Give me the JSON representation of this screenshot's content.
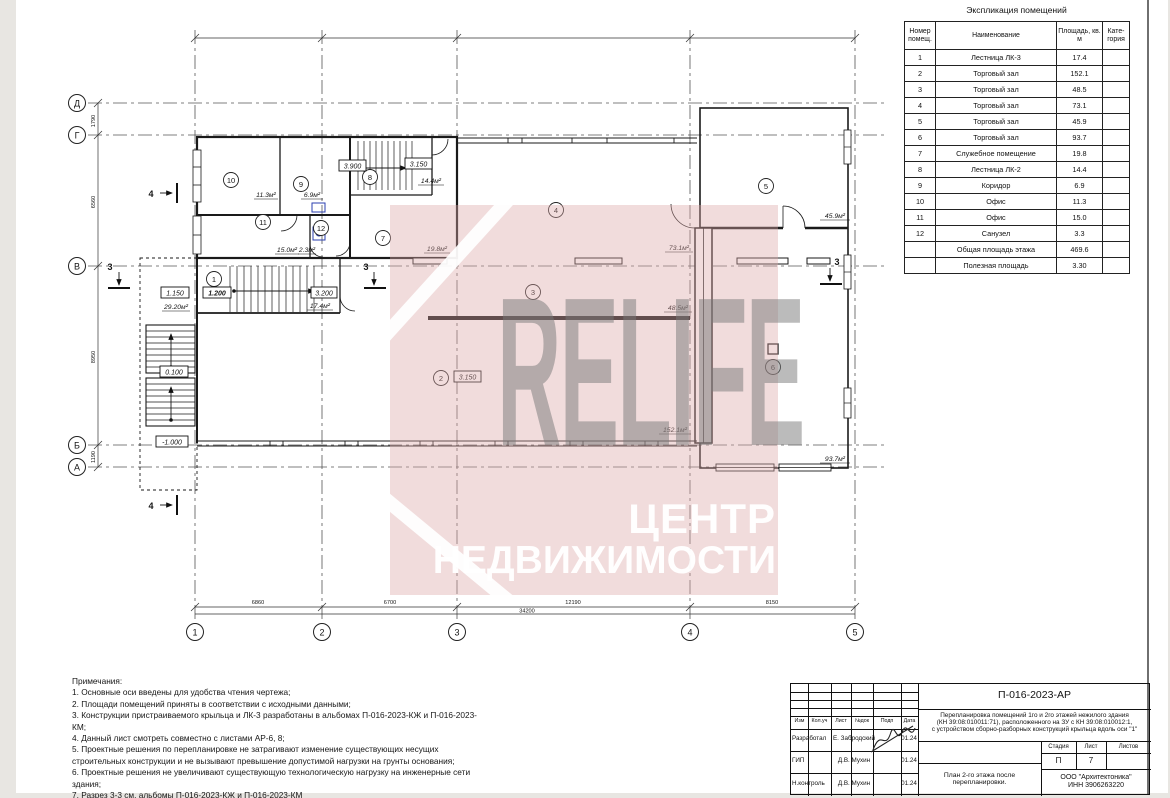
{
  "watermark": {
    "brand": "RELIFE",
    "line1": "ЦЕНТР",
    "line2": "НЕДВИЖИМОСТИ"
  },
  "explication": {
    "title": "Экспликация помещений",
    "headers": [
      "Номер помещ.",
      "Наименование",
      "Площадь, кв. м",
      "Кате-гория"
    ],
    "rows": [
      {
        "num": "1",
        "name": "Лестница ЛК-3",
        "area": "17.4"
      },
      {
        "num": "2",
        "name": "Торговый зал",
        "area": "152.1"
      },
      {
        "num": "3",
        "name": "Торговый зал",
        "area": "48.5"
      },
      {
        "num": "4",
        "name": "Торговый зал",
        "area": "73.1"
      },
      {
        "num": "5",
        "name": "Торговый зал",
        "area": "45.9"
      },
      {
        "num": "6",
        "name": "Торговый зал",
        "area": "93.7"
      },
      {
        "num": "7",
        "name": "Служебное помещение",
        "area": "19.8"
      },
      {
        "num": "8",
        "name": "Лестница ЛК-2",
        "area": "14.4"
      },
      {
        "num": "9",
        "name": "Коридор",
        "area": "6.9"
      },
      {
        "num": "10",
        "name": "Офис",
        "area": "11.3"
      },
      {
        "num": "11",
        "name": "Офис",
        "area": "15.0"
      },
      {
        "num": "12",
        "name": "Санузел",
        "area": "3.3"
      }
    ],
    "totals": [
      {
        "name": "Общая площадь этажа",
        "area": "469.6"
      },
      {
        "name": "Полезная площадь",
        "area": "3.30"
      }
    ]
  },
  "notes": {
    "title": "Примечания:",
    "items": [
      "1. Основные оси введены для удобства чтения чертежа;",
      "2. Площади помещений приняты в соответствии с исходными данными;",
      "3. Конструкции пристраиваемого крыльца и ЛК-3 разработаны в альбомах П-016-2023-КЖ и П-016-2023-КМ;",
      "4. Данный лист смотреть совместно с листами АР-6, 8;",
      "5. Проектные решения по перепланировке не затрагивают изменение существующих несущих строительных конструкции и не вызывают превышение допустимой нагрузки на грунты основания;",
      "6. Проектные решения не увеличивают существующую технологическую нагрузку на инженерные сети здания;",
      "7. Разрез 3-3 см. альбомы П-016-2023-КЖ и П-016-2023-КМ"
    ]
  },
  "title_block": {
    "code": "П-016-2023-АР",
    "desc_line1": "Перепланировка помещений 1го и 2го этажей нежилого здания",
    "desc_line2": "(КН 39:08:010011:71), расположенного на ЗУ с КН 39:08:010012:1,",
    "desc_line3": "с устройством сборно-разборных конструкций крыльца вдоль оси \"1\"",
    "columns": [
      "Изм",
      "Кол.уч",
      "Лист",
      "№док",
      "Подп",
      "Дата"
    ],
    "staff": [
      {
        "role": "Разработал",
        "name": "Е. Забродский",
        "date": "01.24"
      },
      {
        "role": "ГИП",
        "name": "Д.В. Мухин",
        "date": "01.24"
      },
      {
        "role": "Н.контроль",
        "name": "Д.В. Мухин",
        "date": "01.24"
      }
    ],
    "stage_headers": [
      "Стадия",
      "Лист",
      "Листов"
    ],
    "stage": "П",
    "sheet": "7",
    "sheets": "",
    "caption": "План 2-го этажа после перепланировки.",
    "org_line1": "ООО \"Архитектоника\"",
    "org_line2": "ИНН 3906263220"
  },
  "plan": {
    "axes_rows": [
      "Д",
      "Г",
      "В",
      "Б",
      "А"
    ],
    "axes_cols": [
      "1",
      "2",
      "3",
      "4",
      "5"
    ],
    "dims_bottom": [
      "6860",
      "6700",
      "12190",
      "8150"
    ],
    "dim_total": "34200",
    "dims_left": [
      "1790",
      "6560",
      "8950",
      "1190"
    ],
    "porch_area": "29.20м²",
    "rooms": [
      {
        "n": "1",
        "area": "17.4м²"
      },
      {
        "n": "2",
        "area": "152.1м²"
      },
      {
        "n": "3",
        "area": "48.5м²"
      },
      {
        "n": "4",
        "area": "73.1м²"
      },
      {
        "n": "5",
        "area": "45.9м²"
      },
      {
        "n": "6",
        "area": "93.7м²"
      },
      {
        "n": "7",
        "area": "19.8м²"
      },
      {
        "n": "8",
        "area": "14.4м²"
      },
      {
        "n": "9",
        "area": "6.9м²"
      },
      {
        "n": "10",
        "area": "11.3м²"
      },
      {
        "n": "11",
        "area": "15.0м²"
      },
      {
        "n": "12",
        "area": "2.3м²"
      }
    ],
    "elevations": [
      "3.900",
      "3.150",
      "3.150",
      "1.150",
      "1.200",
      "3.200",
      "0.100",
      "-1.000"
    ],
    "sections": {
      "s3": "3",
      "s4": "4"
    }
  }
}
